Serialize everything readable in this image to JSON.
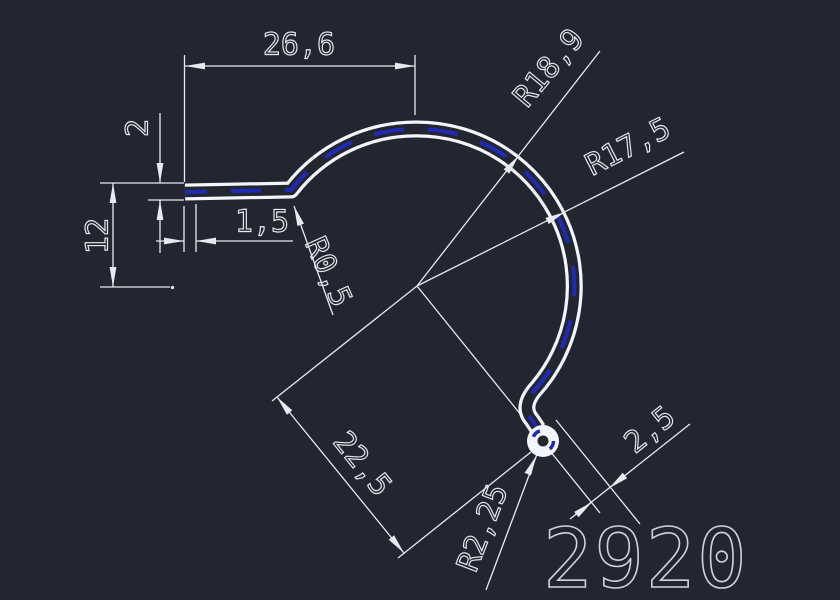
{
  "title": "Extrusion profile technical drawing",
  "colors": {
    "background": "#222631",
    "profile": "#f2f5f9",
    "dimension": "#e7ebf0",
    "centerline_blue": "#202ab4",
    "part_number": "#ced3da"
  },
  "dimensions": {
    "top_width": "26,6",
    "tab_thickness": "2",
    "left_height": "12",
    "tab_lip": "1,5",
    "fillet_radius": "R0,5",
    "outer_radius": "R18,9",
    "inner_radius": "R17,5",
    "opening_distance": "22,5",
    "end_offset": "2,5",
    "ball_radius": "R2,25"
  },
  "part_number": "2920"
}
